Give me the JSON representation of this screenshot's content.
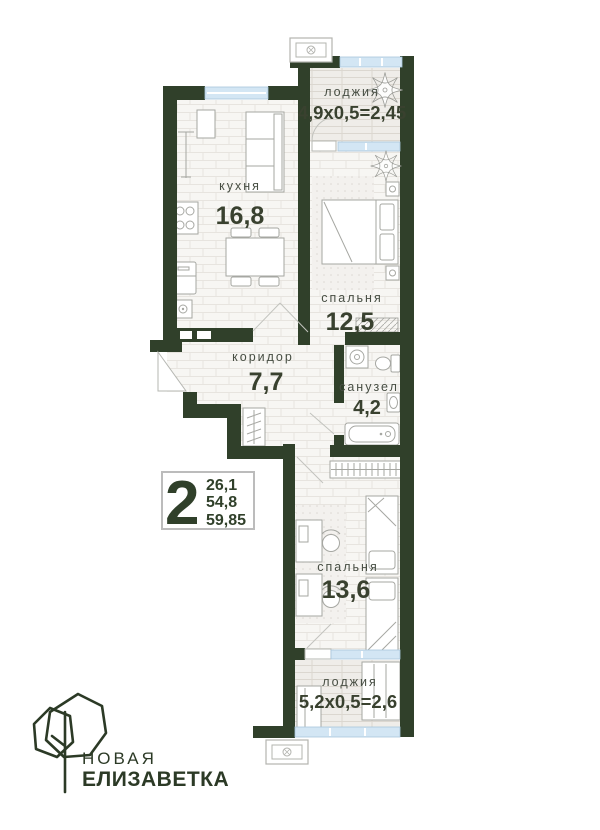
{
  "plan": {
    "rooms": {
      "loggia_top": {
        "name": "лоджия",
        "dims": "4,9х0,5=2,45"
      },
      "kitchen": {
        "name": "кухня",
        "area": "16,8"
      },
      "bedroom_main": {
        "name": "спальня",
        "area": "12,5"
      },
      "corridor": {
        "name": "коридор",
        "area": "7,7"
      },
      "bathroom": {
        "name": "санузел",
        "area": "4,2"
      },
      "bedroom_second": {
        "name": "спальня",
        "area": "13,6"
      },
      "loggia_bottom": {
        "name": "лоджия",
        "dims": "5,2х0,5=2,6"
      }
    },
    "info_badge": {
      "room_count": "2",
      "living_area": "26,1",
      "apartment_area": "54,8",
      "total_area": "59,85"
    }
  },
  "logo": {
    "top": "НОВАЯ",
    "bottom": "ЕЛИЗАВЕТКА"
  },
  "icons": {
    "tree-logo-icon": "overlapping hexagon crowns with trunk line",
    "ac-unit-icon": "outlined box with fan circle",
    "plant-icon": "leaf burst",
    "double-bed-icon": "rect with two pillows",
    "single-bed-icon": "rect with pillow",
    "sofa-icon": "rect with back cushion",
    "stove-icon": "rect with 4 burner circles",
    "fridge-icon": "rounded rect with handle",
    "kitchen-sink-icon": "square with faucet circle",
    "dining-table-icon": "rect with 4 chairs",
    "floor-lamp-icon": "vertical line with caps",
    "wardrobe-icon": "rect with hanger rail ticks",
    "washing-machine-icon": "square with round door",
    "toilet-icon": "tank and bowl",
    "bath-sink-icon": "rect with oval basin",
    "bathtub-icon": "rounded rect with drain",
    "desk-chair-icon": "desk rect with round chair",
    "door-swing-icon": "leaf line with arc"
  },
  "colors": {
    "wall": "#30402a",
    "logo": "#2c3a26",
    "glazing": "#d3e6f4",
    "text_label": "#474e43",
    "text_value": "#39412f",
    "badge_border": "#bcbcbc",
    "furniture": "#a6a7a2"
  }
}
